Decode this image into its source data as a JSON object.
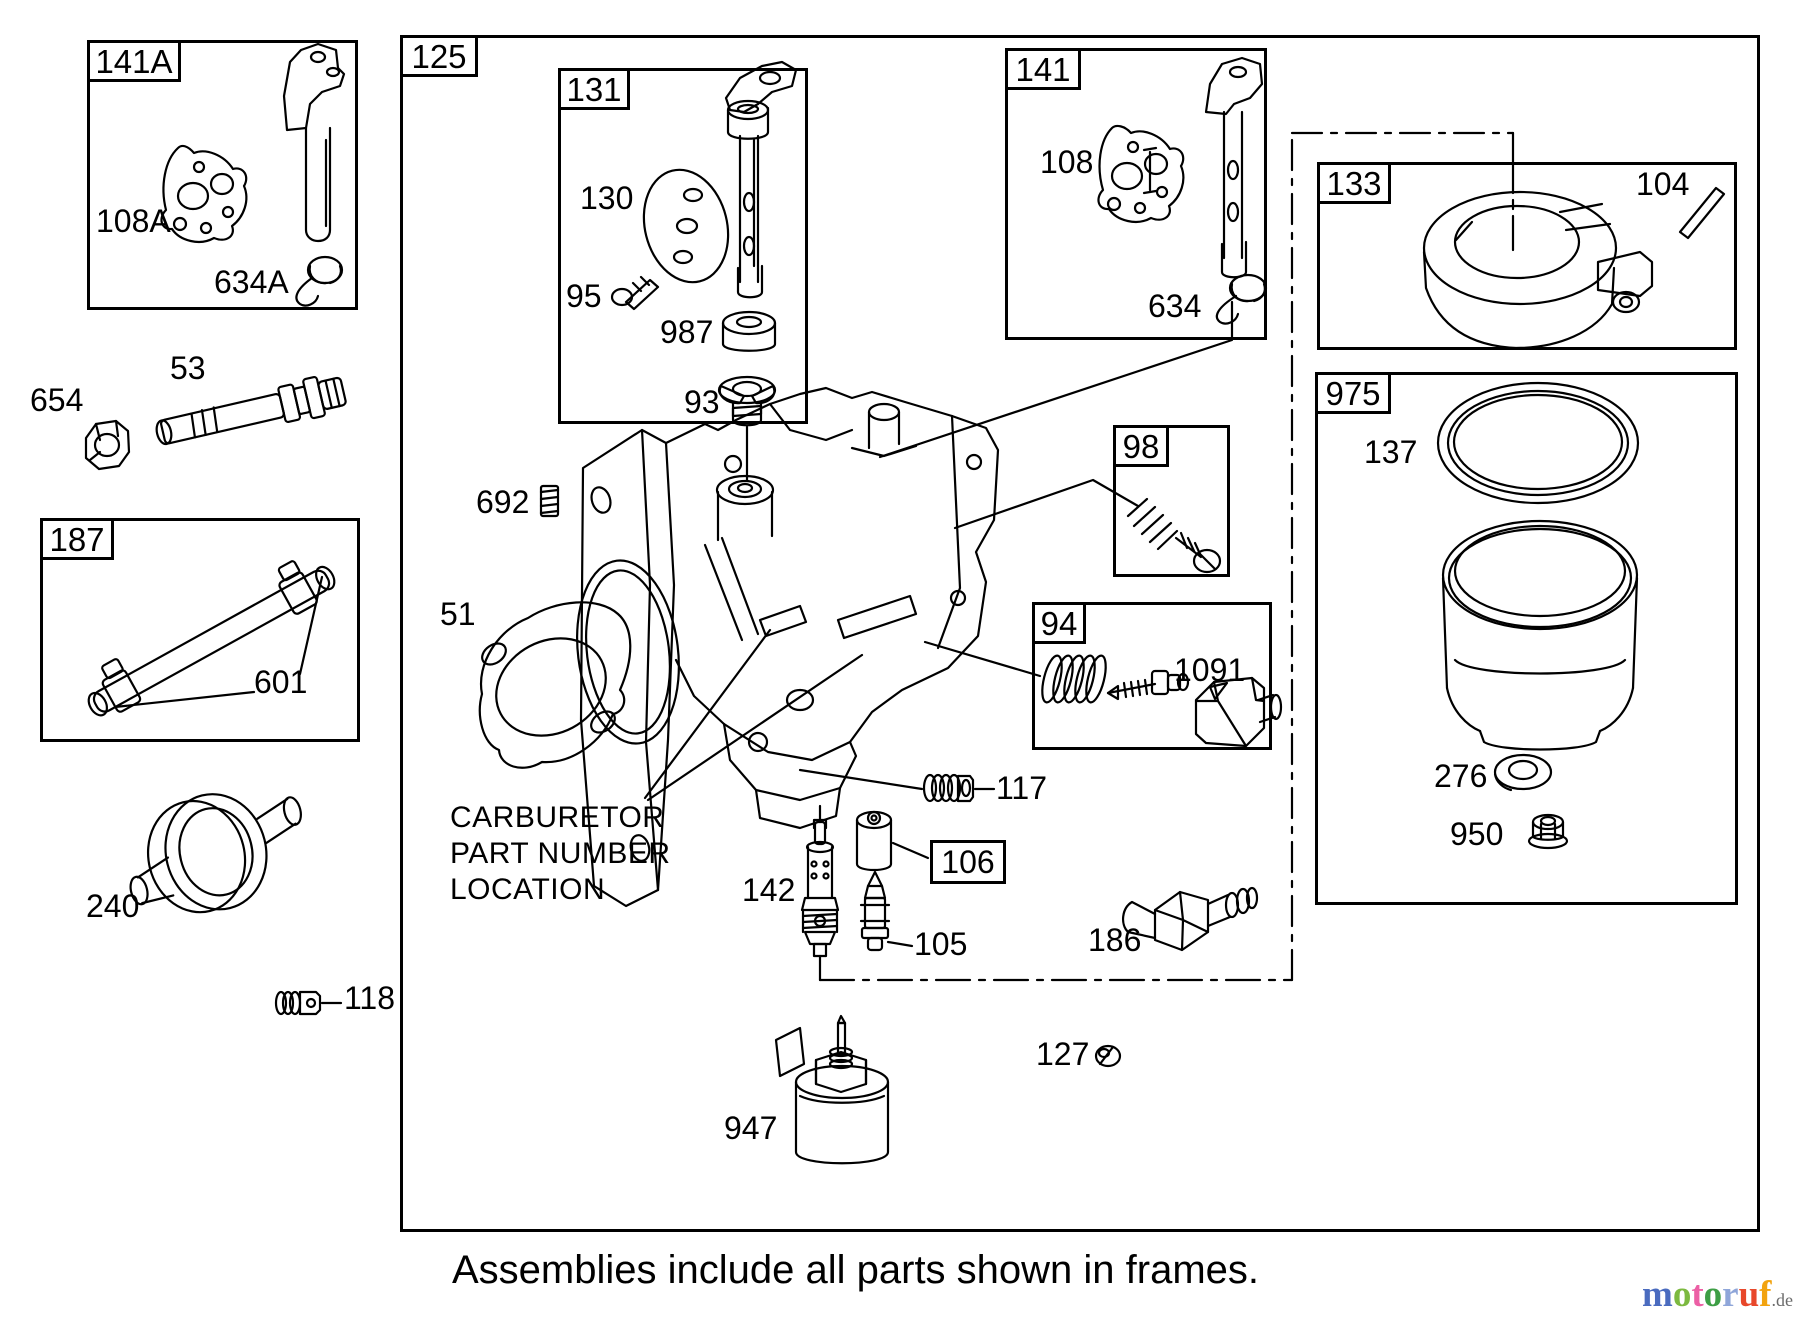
{
  "canvas": {
    "width": 1800,
    "height": 1319,
    "background": "#ffffff",
    "ink": "#000000"
  },
  "caption": "Assemblies include all parts shown in frames.",
  "annotation": {
    "line1": "CARBURETOR",
    "line2": "PART NUMBER",
    "line3": "LOCATION"
  },
  "frames": [
    {
      "id": "141A",
      "label": "141A",
      "x": 87,
      "y": 40,
      "w": 271,
      "h": 270,
      "tab_w": 94,
      "tab_h": 42
    },
    {
      "id": "125",
      "label": "125",
      "x": 400,
      "y": 35,
      "w": 1360,
      "h": 1197,
      "tab_w": 78,
      "tab_h": 42
    },
    {
      "id": "131",
      "label": "131",
      "x": 558,
      "y": 68,
      "w": 250,
      "h": 356,
      "tab_w": 72,
      "tab_h": 42
    },
    {
      "id": "141",
      "label": "141",
      "x": 1005,
      "y": 48,
      "w": 262,
      "h": 292,
      "tab_w": 76,
      "tab_h": 42
    },
    {
      "id": "133",
      "label": "133",
      "x": 1317,
      "y": 162,
      "w": 420,
      "h": 188,
      "tab_w": 74,
      "tab_h": 42
    },
    {
      "id": "975",
      "label": "975",
      "x": 1315,
      "y": 372,
      "w": 423,
      "h": 533,
      "tab_w": 76,
      "tab_h": 42
    },
    {
      "id": "98",
      "label": "98",
      "x": 1113,
      "y": 425,
      "w": 117,
      "h": 152,
      "tab_w": 56,
      "tab_h": 42
    },
    {
      "id": "94",
      "label": "94",
      "x": 1032,
      "y": 602,
      "w": 240,
      "h": 148,
      "tab_w": 54,
      "tab_h": 42
    },
    {
      "id": "187",
      "label": "187",
      "x": 40,
      "y": 518,
      "w": 320,
      "h": 224,
      "tab_w": 74,
      "tab_h": 42
    }
  ],
  "part_labels": [
    {
      "id": "108A",
      "text": "108A",
      "x": 96,
      "y": 205
    },
    {
      "id": "634A",
      "text": "634A",
      "x": 214,
      "y": 266
    },
    {
      "id": "53",
      "text": "53",
      "x": 170,
      "y": 352
    },
    {
      "id": "654",
      "text": "654",
      "x": 30,
      "y": 384
    },
    {
      "id": "601",
      "text": "601",
      "x": 254,
      "y": 666
    },
    {
      "id": "240",
      "text": "240",
      "x": 86,
      "y": 890
    },
    {
      "id": "118",
      "text": "118",
      "x": 344,
      "y": 982
    },
    {
      "id": "692",
      "text": "692",
      "x": 476,
      "y": 486
    },
    {
      "id": "51",
      "text": "51",
      "x": 440,
      "y": 598
    },
    {
      "id": "130",
      "text": "130",
      "x": 580,
      "y": 182
    },
    {
      "id": "95",
      "text": "95",
      "x": 566,
      "y": 280
    },
    {
      "id": "987",
      "text": "987",
      "x": 660,
      "y": 316
    },
    {
      "id": "93",
      "text": "93",
      "x": 684,
      "y": 386
    },
    {
      "id": "108",
      "text": "108",
      "x": 1040,
      "y": 146
    },
    {
      "id": "634",
      "text": "634",
      "x": 1148,
      "y": 290
    },
    {
      "id": "104",
      "text": "104",
      "x": 1636,
      "y": 168
    },
    {
      "id": "137",
      "text": "137",
      "x": 1364,
      "y": 436
    },
    {
      "id": "276",
      "text": "276",
      "x": 1434,
      "y": 760
    },
    {
      "id": "950",
      "text": "950",
      "x": 1450,
      "y": 818
    },
    {
      "id": "117",
      "text": "117",
      "x": 996,
      "y": 772
    },
    {
      "id": "142",
      "text": "142",
      "x": 742,
      "y": 874
    },
    {
      "id": "105",
      "text": "105",
      "x": 914,
      "y": 928
    },
    {
      "id": "1091",
      "text": "1091",
      "x": 1174,
      "y": 654
    },
    {
      "id": "186",
      "text": "186",
      "x": 1088,
      "y": 924
    },
    {
      "id": "127",
      "text": "127",
      "x": 1036,
      "y": 1038
    },
    {
      "id": "947",
      "text": "947",
      "x": 724,
      "y": 1112
    }
  ],
  "boxed_labels": [
    {
      "id": "106",
      "text": "106",
      "x": 930,
      "y": 840,
      "w": 76,
      "h": 44
    }
  ],
  "logo": {
    "letters": [
      {
        "ch": "m",
        "color": "#4a6bbf"
      },
      {
        "ch": "o",
        "color": "#7cb940"
      },
      {
        "ch": "t",
        "color": "#ec5fa5"
      },
      {
        "ch": "o",
        "color": "#3d9e45"
      },
      {
        "ch": "r",
        "color": "#8fa6d9"
      },
      {
        "ch": "u",
        "color": "#e8482b"
      },
      {
        "ch": "f",
        "color": "#f2a30f"
      }
    ],
    "suffix": ".de",
    "suffix_color": "#6b6b6b"
  }
}
